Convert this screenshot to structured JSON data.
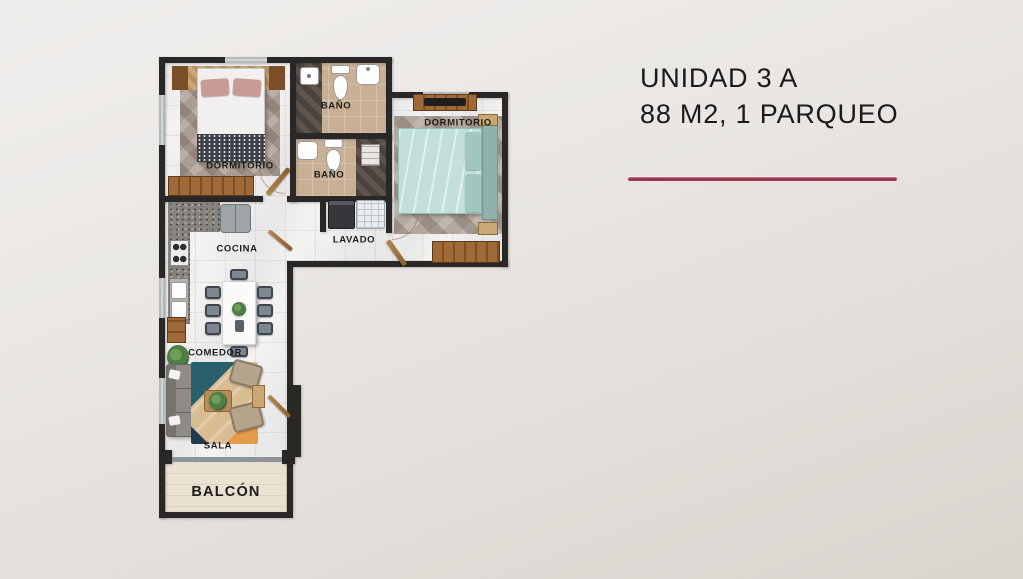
{
  "title": {
    "line1": "UNIDAD 3 A",
    "line2": "88 M2, 1 PARQUEO"
  },
  "floorplan": {
    "rooms": {
      "dormitorio1": "DORMITORIO",
      "bano1": "BAÑO",
      "bano2": "BAÑO",
      "dormitorio2": "DORMITORIO",
      "lavado": "LAVADO",
      "cocina": "COCINA",
      "comedor": "COMEDOR",
      "sala": "SALA",
      "balcon": "BALCÓN"
    }
  },
  "theme": {
    "accent": "#9c3750",
    "wall": "#2a2826",
    "marble": "#f4f3f1",
    "bath": "#c9af94",
    "wood": "#9a6434",
    "bed2": "#c2e0d9",
    "ink": "#1a1a1a"
  }
}
